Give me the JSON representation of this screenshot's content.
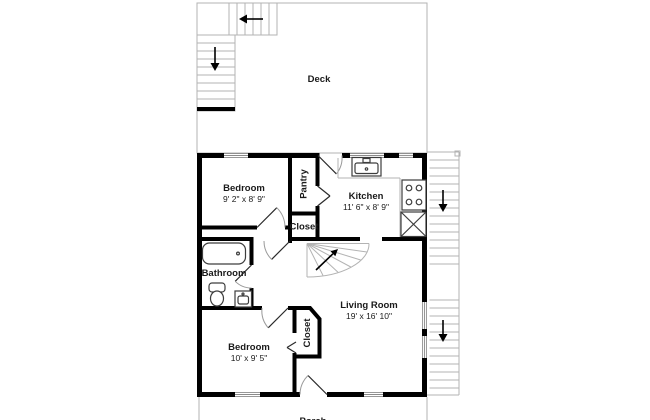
{
  "floor_plan": {
    "rooms": {
      "deck": {
        "label": "Deck"
      },
      "bedroom_upper": {
        "label": "Bedroom",
        "dims": "9' 2\" x 8' 9\""
      },
      "pantry": {
        "label": "Pantry"
      },
      "kitchen": {
        "label": "Kitchen",
        "dims": "11' 6\" x 8' 9\""
      },
      "closet_upper": {
        "label": "Closet"
      },
      "bathroom": {
        "label": "Bathroom"
      },
      "living_room": {
        "label": "Living Room",
        "dims": "19' x 16' 10\""
      },
      "bedroom_lower": {
        "label": "Bedroom",
        "dims": "10' x 9' 5\""
      },
      "closet_lower": {
        "label": "Closet"
      },
      "porch": {
        "label": "Porch"
      }
    },
    "icons": {
      "stair_arrow_down": "↓",
      "stair_arrow_left": "←",
      "stair_arrow_up_right": "↗"
    },
    "colors": {
      "wall": "#000000",
      "thin_line": "#b3b3b3",
      "text": "#1a1a1a",
      "background": "#ffffff"
    }
  }
}
